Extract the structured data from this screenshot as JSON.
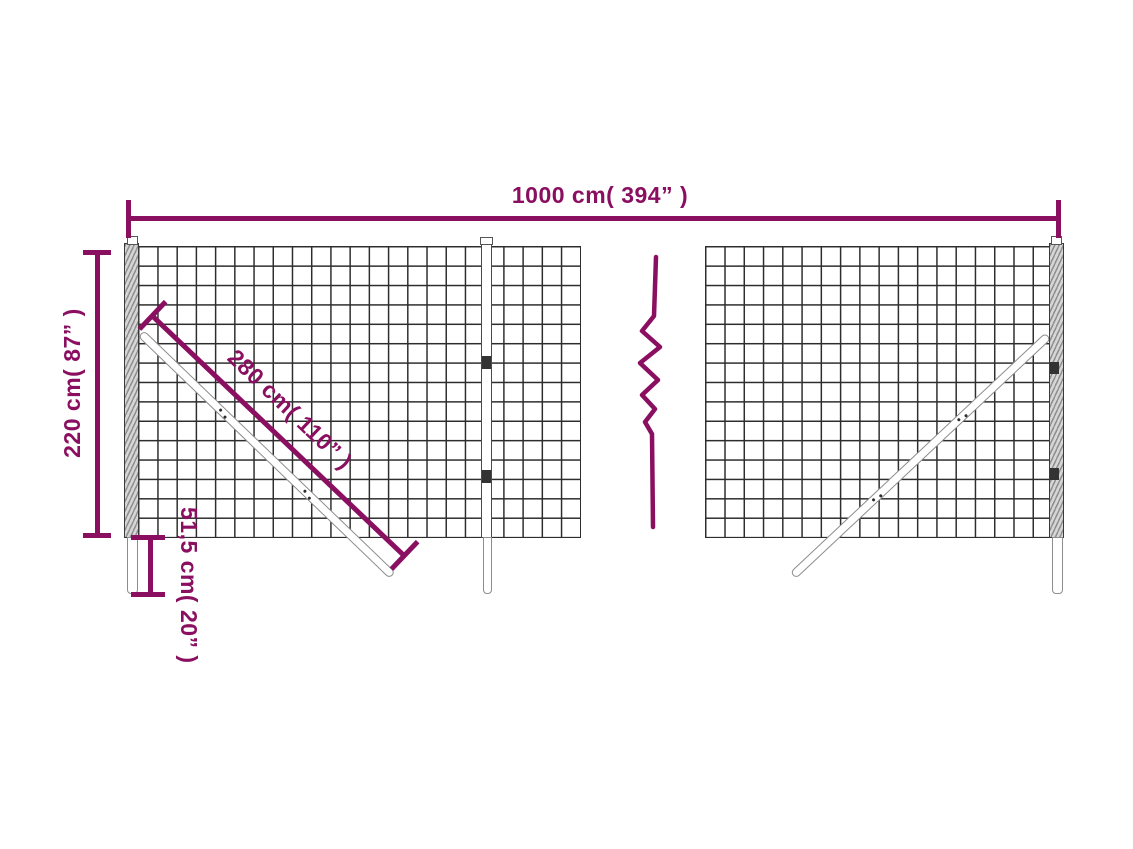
{
  "colors": {
    "accent": "#8a0f60",
    "mesh_line": "#2d2d2d",
    "post_border": "#3a3a3a",
    "brace_border": "#8d8d8d",
    "background": "#ffffff"
  },
  "dimensions": {
    "total_width": {
      "label": "1000 cm( 394” )"
    },
    "height": {
      "label": "220 cm( 87” )"
    },
    "brace_length": {
      "label": "280 cm( 110” )"
    },
    "ground_depth": {
      "label": "51,5 cm( 20” )"
    }
  }
}
